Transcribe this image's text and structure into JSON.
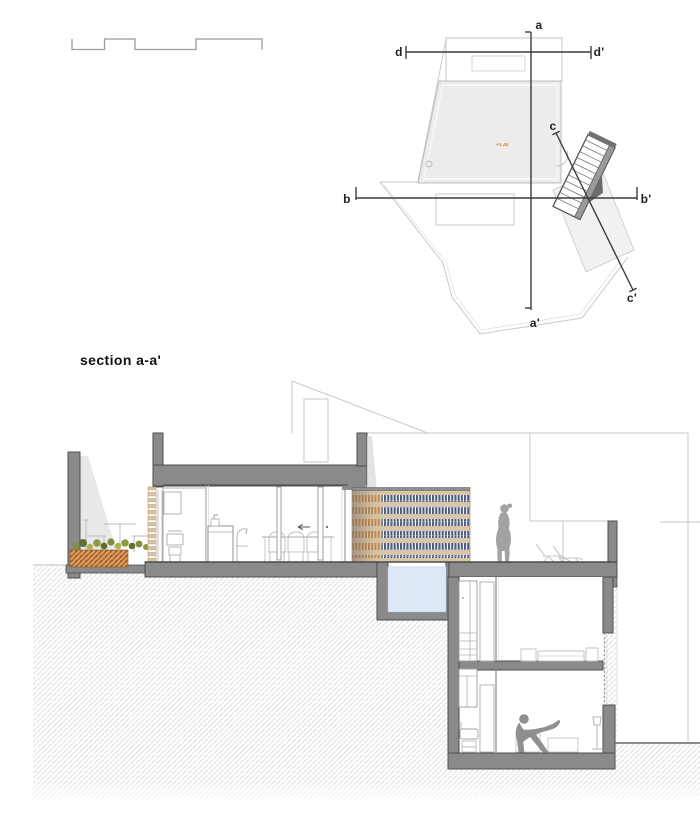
{
  "sheet": {
    "kind": "architectural drawing",
    "background": "#ffffff"
  },
  "plan": {
    "labels": {
      "a_start": "a",
      "a_end": "a'",
      "b_start": "b",
      "b_end": "b'",
      "c_start": "c",
      "c_end": "c'",
      "d_start": "d",
      "d_end": "d'"
    },
    "level_annotation": "+1.40"
  },
  "section": {
    "title": "section a-a'"
  },
  "colors": {
    "cut_wall": "#8a8a8a",
    "wall_outline": "#4f4f4f",
    "background_line": "#c7c7c7",
    "ground_hatch_line": "#e0e0e0",
    "pool_water": "#dde8f7",
    "soil": "#bf7434",
    "screen_tan": "#d9c6a8",
    "screen_slat_blue": "#4e5e7f",
    "screen_brick_orange": "#c08a52",
    "figure_gray": "#9e9e9e",
    "label_ink": "#222222",
    "level_annotation_color": "#c87a3a"
  }
}
